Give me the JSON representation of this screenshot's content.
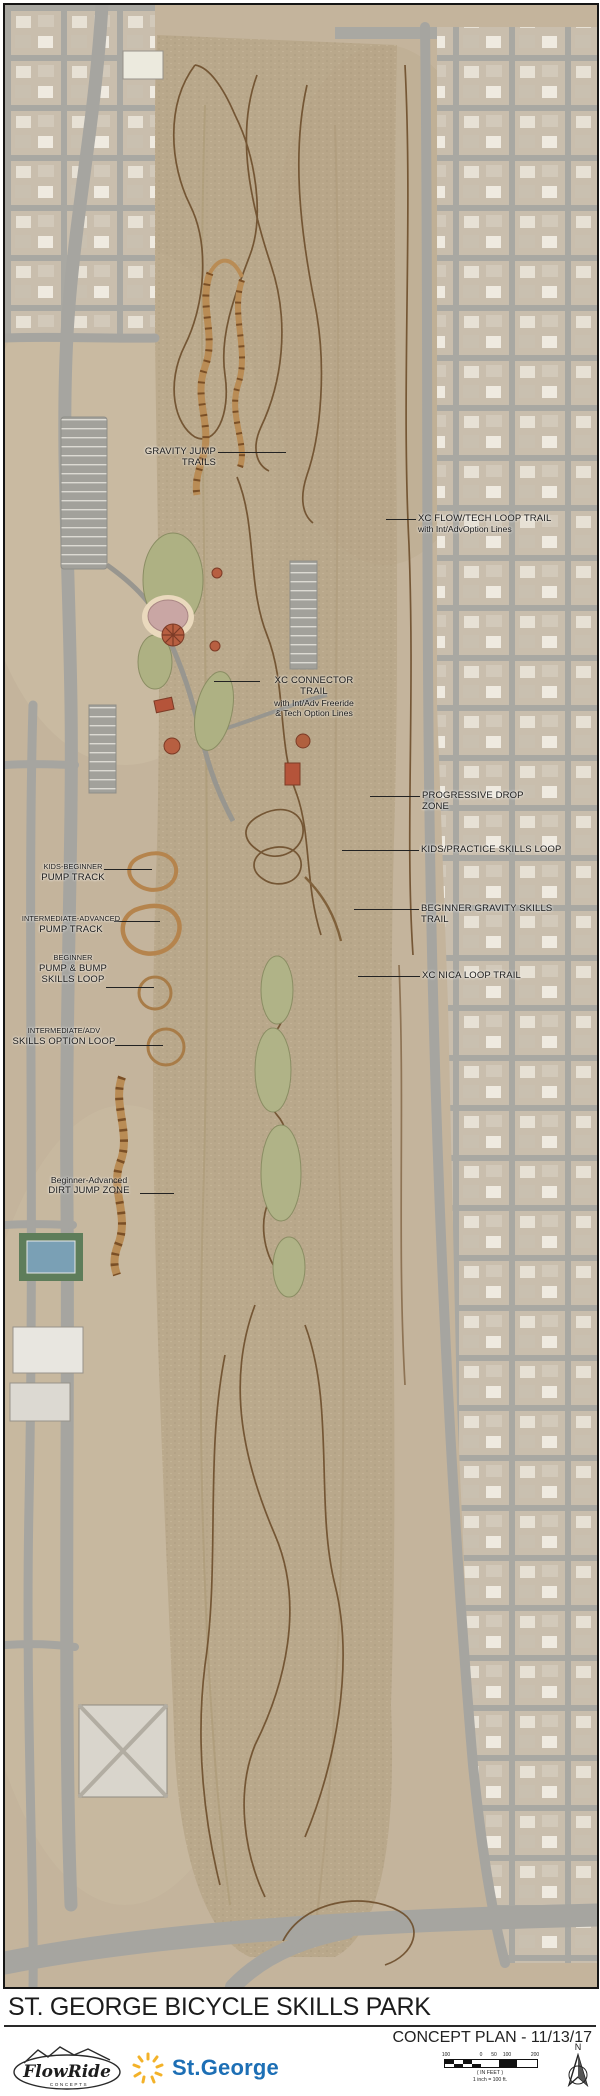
{
  "map": {
    "labels": [
      {
        "line1": "GRAVITY JUMP TRAILS"
      },
      {
        "line1": "XC FLOW/TECH LOOP TRAIL",
        "line2": "with Int/AdvOption Lines"
      },
      {
        "line1": "XC CONNECTOR TRAIL",
        "line2": "with Int/Adv Freeride",
        "line3": "& Tech Option Lines"
      },
      {
        "line1": "PROGRESSIVE DROP ZONE"
      },
      {
        "line1": "KIDS/PRACTICE SKILLS LOOP"
      },
      {
        "line1": "BEGINNER GRAVITY SKILLS TRAIL"
      },
      {
        "line1": "XC NICA LOOP TRAIL"
      },
      {
        "line1": "KIDS-BEGINNER",
        "line2": "PUMP TRACK"
      },
      {
        "line1": "INTERMEDIATE-ADVANCED",
        "line2": "PUMP TRACK"
      },
      {
        "line1": "BEGINNER",
        "line2": "PUMP & BUMP",
        "line3": "SKILLS LOOP"
      },
      {
        "line1": "INTERMEDIATE/ADV",
        "line2": "SKILLS OPTION LOOP"
      },
      {
        "line1": "Beginner-Advanced",
        "line2": "DIRT JUMP ZONE"
      }
    ]
  },
  "footer": {
    "title": "ST. GEORGE BICYCLE SKILLS PARK",
    "plan_label": "CONCEPT PLAN - 11/13/17",
    "flowride": {
      "name": "FlowRide",
      "tagline": "CONCEPTS"
    },
    "city_name": "St.George",
    "scale": {
      "ticks": [
        "100",
        "0",
        "50",
        "100",
        "200"
      ],
      "units_label": "( IN FEET )",
      "ratio_label": "1 inch = 100 ft."
    },
    "north_label": "N"
  },
  "colors": {
    "city_blue": "#1d6fb5",
    "sun_yellow": "#f3b229",
    "label_text": "#1a1a1a",
    "trail_brown": "#6d4d2b",
    "designed_trail_tan": "#b98c55",
    "pavilion_red": "#b5543a",
    "grass_green": "#aeb183"
  }
}
